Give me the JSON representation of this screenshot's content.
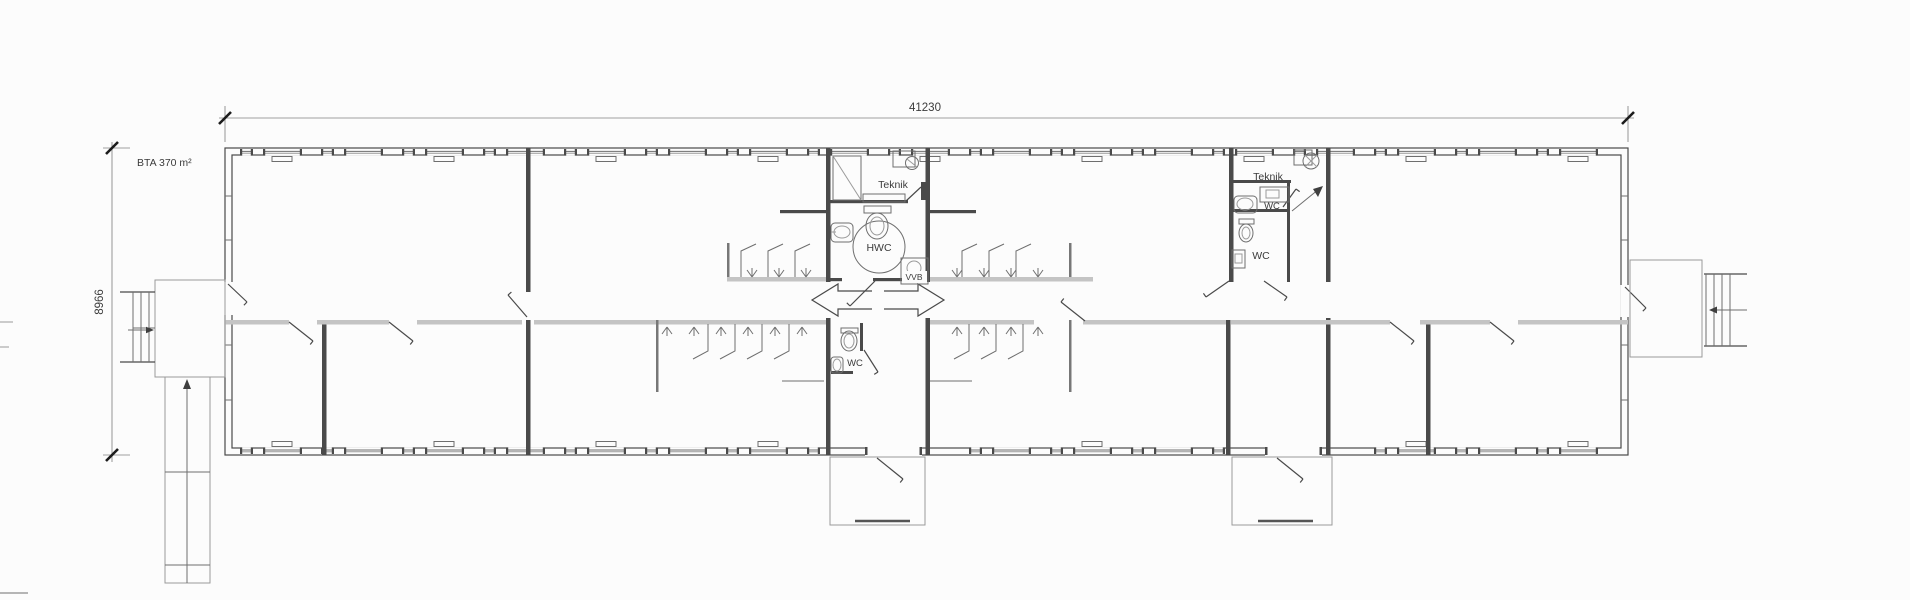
{
  "drawing": {
    "dimensions": {
      "width_mm": "41230",
      "height_mm": "8966"
    },
    "area_label": "BTA 370 m²",
    "rooms": {
      "teknik_left": "Teknik",
      "hwc": "HWC",
      "vvb": "VVB",
      "wc_entrance": "WC",
      "teknik_right": "Teknik",
      "wc_right_upper": "WC",
      "wc_right_lower": "WC"
    },
    "colors": {
      "wall": "#4a4a4a",
      "interior_gray_wall": "#c4c4c4",
      "paper": "#fcfcfc"
    }
  }
}
